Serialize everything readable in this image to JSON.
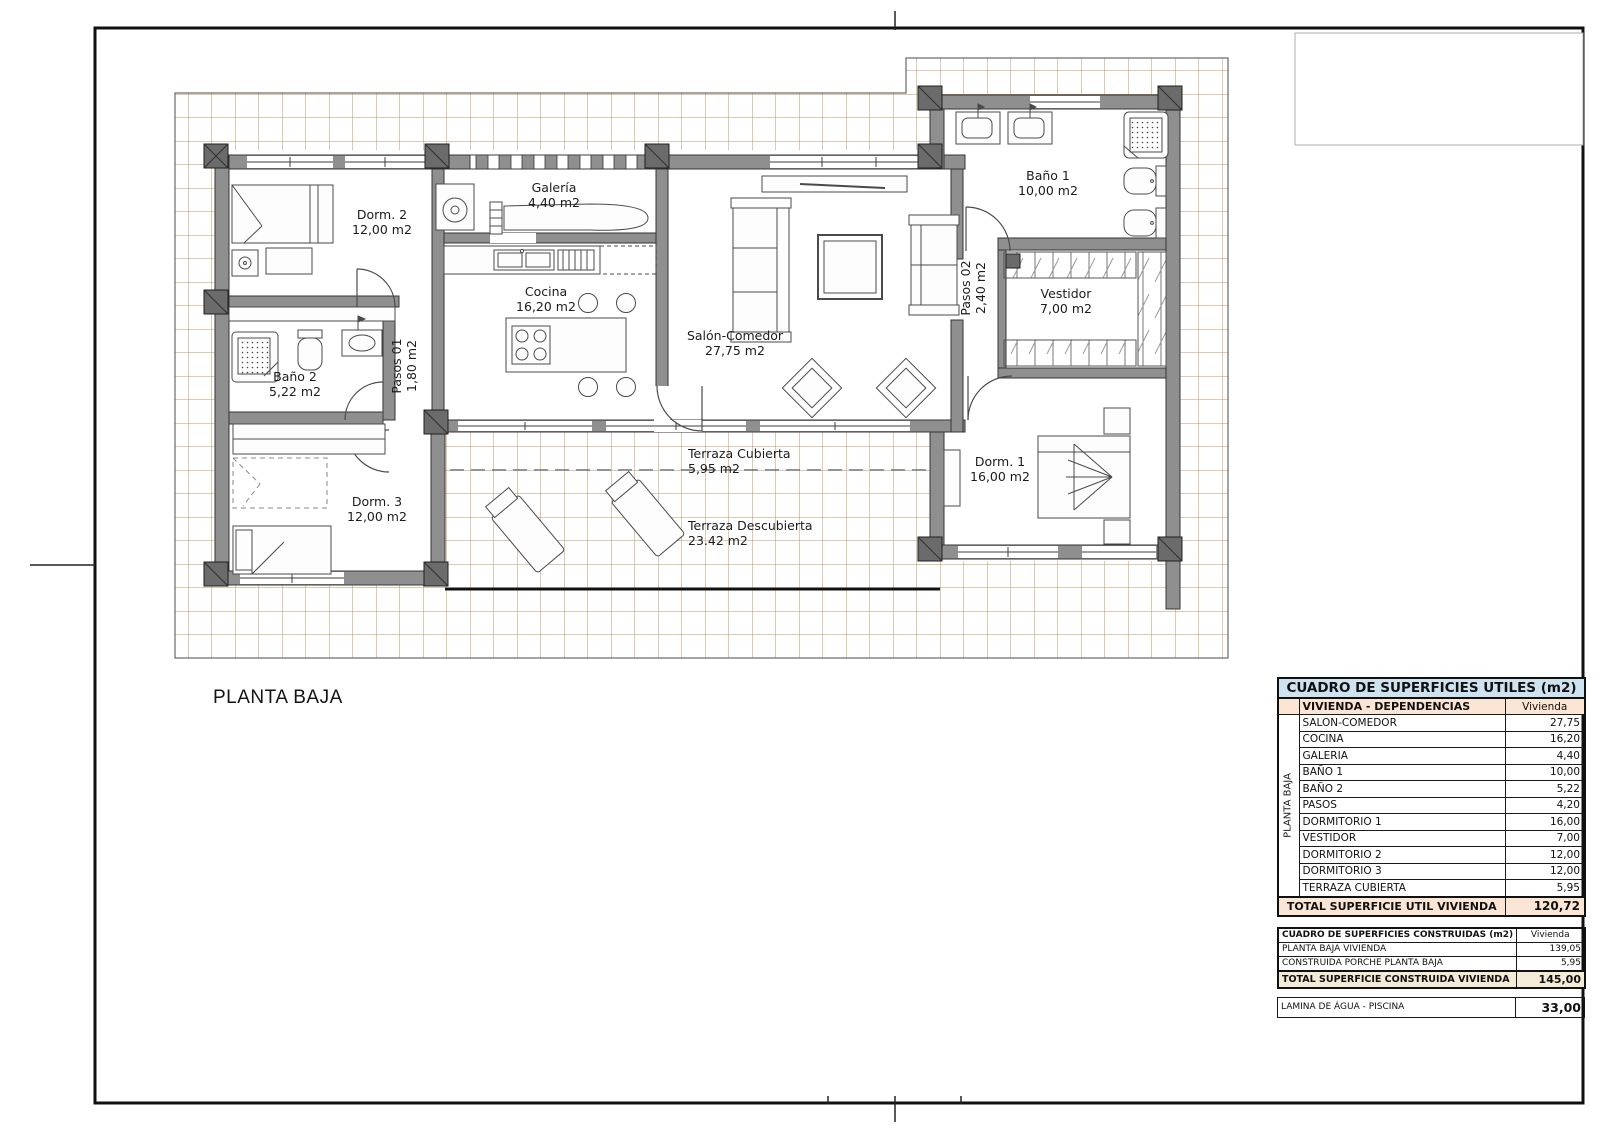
{
  "sheet": {
    "floor_caption": "PLANTA BAJA"
  },
  "plan": {
    "rooms": {
      "dorm2": {
        "label": "Dorm. 2",
        "area": "12,00 m2"
      },
      "galeria": {
        "label": "Galería",
        "area": "4,40 m2"
      },
      "cocina": {
        "label": "Cocina",
        "area": "16,20 m2"
      },
      "bano2": {
        "label": "Baño 2",
        "area": "5,22 m2"
      },
      "pasos01": {
        "label": "Pasos 01",
        "area": "1,80 m2"
      },
      "salon": {
        "label": "Salón-Comedor",
        "area": "27,75 m2"
      },
      "bano1": {
        "label": "Baño 1",
        "area": "10,00 m2"
      },
      "pasos02": {
        "label": "Pasos 02",
        "area": "2,40 m2"
      },
      "vestidor": {
        "label": "Vestidor",
        "area": "7,00 m2"
      },
      "dorm3": {
        "label": "Dorm. 3",
        "area": "12,00 m2"
      },
      "dorm1": {
        "label": "Dorm. 1",
        "area": "16,00 m2"
      },
      "terraza_cubierta": {
        "label": "Terraza Cubierta",
        "area": "5,95 m2"
      },
      "terraza_descubierta": {
        "label": "Terraza Descubierta",
        "area": "23.42 m2"
      }
    }
  },
  "tables": {
    "utiles": {
      "title": "CUADRO DE SUPERFICIES UTILES (m2)",
      "group_label": "PLANTA BAJA",
      "header": {
        "left": "VIVIENDA - DEPENDENCIAS",
        "right": "Vivienda"
      },
      "rows": [
        {
          "label": "SALON-COMEDOR",
          "value": "27,75"
        },
        {
          "label": "COCINA",
          "value": "16,20"
        },
        {
          "label": "GALERIA",
          "value": "4,40"
        },
        {
          "label": "BAÑO 1",
          "value": "10,00"
        },
        {
          "label": "BAÑO 2",
          "value": "5,22"
        },
        {
          "label": "PASOS",
          "value": "4,20"
        },
        {
          "label": "DORMITORIO 1",
          "value": "16,00"
        },
        {
          "label": "VESTIDOR",
          "value": "7,00"
        },
        {
          "label": "DORMITORIO 2",
          "value": "12,00"
        },
        {
          "label": "DORMITORIO 3",
          "value": "12,00"
        },
        {
          "label": "TERRAZA CUBIERTA",
          "value": "5,95"
        }
      ],
      "total": {
        "label": "TOTAL SUPERFICIE UTIL VIVIENDA",
        "value": "120,72"
      }
    },
    "construidas": {
      "header": {
        "left": "CUADRO DE SUPERFICIES CONSTRUIDAS (m2)",
        "right": "Vivienda"
      },
      "rows": [
        {
          "label": "PLANTA BAJA VIVIENDA",
          "value": "139,05"
        },
        {
          "label": "CONSTRUIDA PORCHE PLANTA BAJA",
          "value": "5,95"
        }
      ],
      "total": {
        "label": "TOTAL SUPERFICIE CONSTRUIDA VIVIENDA",
        "value": "145,00"
      }
    },
    "piscina": {
      "label": "LAMINA DE ÁGUA - PISCINA",
      "value": "33,00"
    }
  },
  "colors": {
    "wall_gray": "#8f8f8f",
    "tile_line": "#bd9361",
    "table_title_bg": "#cfe2f0",
    "table_accent_bg": "#fbe5d5",
    "frame": "#111111"
  }
}
